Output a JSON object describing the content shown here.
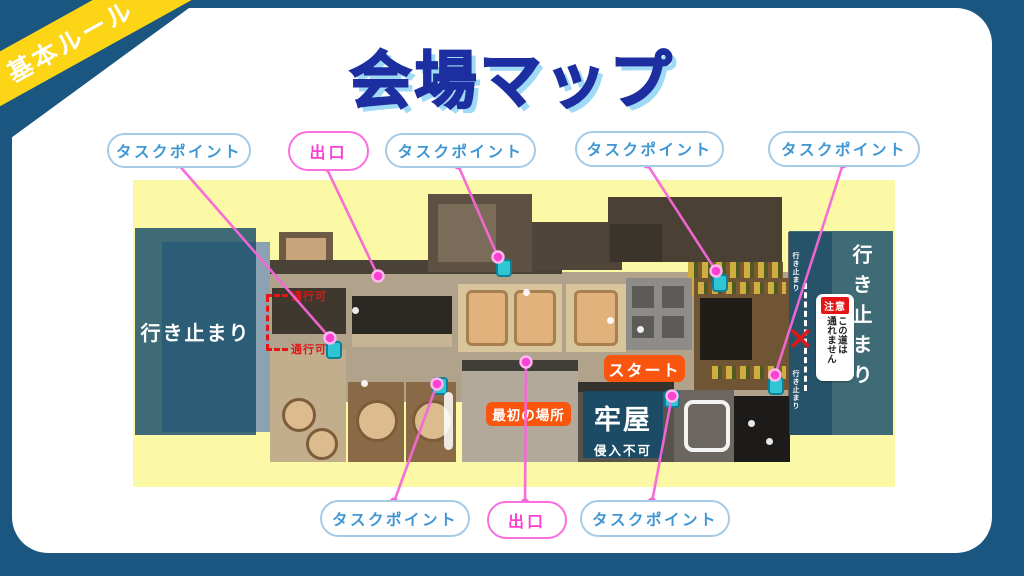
{
  "ribbon": {
    "label": "基本ルール"
  },
  "title": "会場マップ",
  "pills": {
    "top": [
      {
        "label": "タスクポイント",
        "type": "task"
      },
      {
        "label": "出口",
        "type": "exit"
      },
      {
        "label": "タスクポイント",
        "type": "task"
      },
      {
        "label": "タスクポイント",
        "type": "task"
      },
      {
        "label": "タスクポイント",
        "type": "task"
      }
    ],
    "bottom": [
      {
        "label": "タスクポイント",
        "type": "task"
      },
      {
        "label": "出口",
        "type": "exit"
      },
      {
        "label": "タスクポイント",
        "type": "task"
      }
    ]
  },
  "map": {
    "dead_end_left": "行き止まり",
    "dead_end_right": "行き止まり",
    "dead_end_small_top": "行き止まり",
    "dead_end_small_bottom": "行き止まり",
    "jail": {
      "title": "牢屋",
      "subtitle": "侵入不可"
    },
    "start": "スタート",
    "first_place": "最初の場所",
    "passable_top": "通行可",
    "passable_bottom": "通行可",
    "caution": {
      "badge": "注意",
      "column_right": "この道は",
      "column_left": "通れません"
    },
    "x_mark": "✕"
  },
  "colors": {
    "frame_blue": "#1a5680",
    "title_blue": "#1d2fa0",
    "title_shadow": "#9ed9f6",
    "ribbon_yellow": "#fcd516",
    "map_bg_yellow": "#fbf8a6",
    "pill_task_blue": "#3e96d3",
    "pill_exit_pink": "#fb3fd0",
    "connector_pink": "#f767d8",
    "badge_orange": "#f8560e",
    "warning_red": "#e51515",
    "overlay_navy": "rgba(25,80,107,0.84)"
  }
}
